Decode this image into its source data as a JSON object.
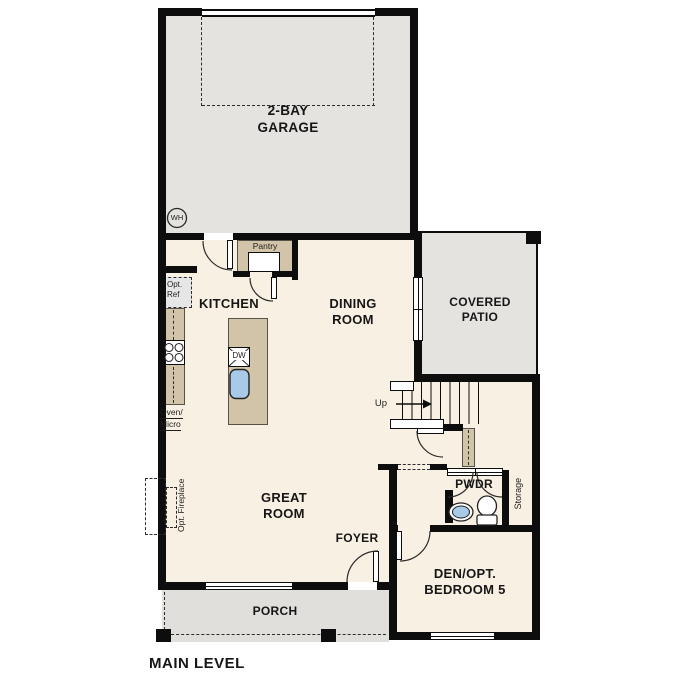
{
  "plan_title": "MAIN LEVEL",
  "colors": {
    "wall": "#0d0d0d",
    "floor": "#f8f0e2",
    "garage_floor": "#e4e3e0",
    "porch_floor": "#e0dfdc",
    "cabinet": "#d2c4a8",
    "fixture_blue": "#a9c9e8"
  },
  "rooms": {
    "garage": {
      "l1": "2-BAY",
      "l2": "GARAGE"
    },
    "kitchen": {
      "l1": "KITCHEN"
    },
    "dining": {
      "l1": "DINING",
      "l2": "ROOM"
    },
    "patio": {
      "l1": "COVERED",
      "l2": "PATIO"
    },
    "great": {
      "l1": "GREAT",
      "l2": "ROOM"
    },
    "foyer": {
      "l1": "FOYER"
    },
    "porch": {
      "l1": "PORCH"
    },
    "pwdr": {
      "l1": "PWDR"
    },
    "den": {
      "l1": "DEN/OPT.",
      "l2": "BEDROOM 5"
    },
    "storage": {
      "l1": "Storage"
    }
  },
  "annotations": {
    "water_heater": "WH",
    "pantry": "Pantry",
    "opt_ref_1": "Opt.",
    "opt_ref_2": "Ref",
    "oven_1": "Oven/",
    "oven_2": "Micro",
    "dishwasher": "DW",
    "stairs_up": "Up",
    "opt_fireplace": "Opt. Fireplace"
  }
}
